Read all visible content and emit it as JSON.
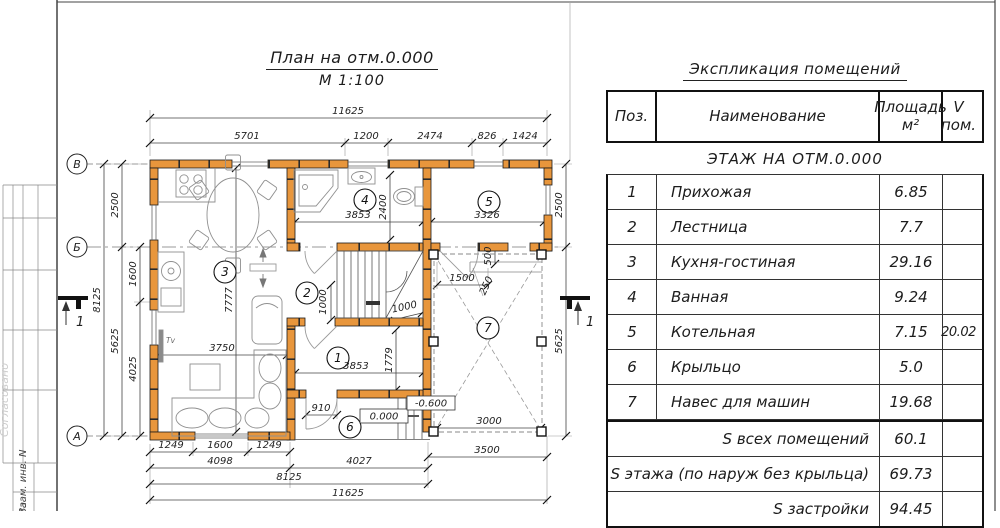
{
  "frame": {
    "approved_label": "Согласовано",
    "inv_label": "Взам. инв. N",
    "date_label": "та"
  },
  "title": {
    "line1": "План на отм.0.000",
    "line2": "М 1:100"
  },
  "axes": {
    "top": "В",
    "mid": "Б",
    "bottom": "А",
    "section": "1"
  },
  "labels": {
    "tv": "Tv"
  },
  "levels": {
    "zero": "0.000",
    "minus": "-0.600"
  },
  "rooms": {
    "n1": "1",
    "n2": "2",
    "n3": "3",
    "n4": "4",
    "n5": "5",
    "n6": "6",
    "n7": "7"
  },
  "dims": {
    "top_total": "11625",
    "t1": "5701",
    "t2": "1200",
    "t3": "2474",
    "t4": "826",
    "t5": "1424",
    "l_total": "8125",
    "l_upper": "2500",
    "l_lower": "5625",
    "l_inner_upper": "1600",
    "l_inner_lower": "4025",
    "r_upper": "2500",
    "r_lower": "5625",
    "b1": "1249",
    "b2": "1600",
    "b3": "1249",
    "b4": "4098",
    "b5": "4027",
    "b6": "8125",
    "b7": "11625",
    "b8": "3500",
    "room4_w": "3853",
    "room4_h": "2400",
    "room5_w": "3326",
    "room1_w": "3853",
    "room1_h": "1779",
    "living_w": "3750",
    "living_h": "7777",
    "stairs_v": "1000",
    "stairs_w": "1000",
    "door_w": "910",
    "cp1": "1500",
    "cp2": "500",
    "cp3": "250",
    "cp4": "3000"
  },
  "table": {
    "title": "Экспликация помещений",
    "headers": {
      "pos": "Поз.",
      "name": "Наименование",
      "area_line1": "Площадь",
      "area_line2": "м²",
      "v_line1": "V",
      "v_line2": "пом."
    },
    "section": "ЭТАЖ НА ОТМ.0.000",
    "rows": [
      {
        "pos": "1",
        "name": "Прихожая",
        "area": "6.85",
        "v": ""
      },
      {
        "pos": "2",
        "name": "Лестница",
        "area": "7.7",
        "v": ""
      },
      {
        "pos": "3",
        "name": "Кухня-гостиная",
        "area": "29.16",
        "v": ""
      },
      {
        "pos": "4",
        "name": "Ванная",
        "area": "9.24",
        "v": ""
      },
      {
        "pos": "5",
        "name": "Котельная",
        "area": "7.15",
        "v": "20.02"
      },
      {
        "pos": "6",
        "name": "Крыльцо",
        "area": "5.0",
        "v": ""
      },
      {
        "pos": "7",
        "name": "Навес для машин",
        "area": "19.68",
        "v": ""
      }
    ],
    "summary": [
      {
        "label": "S всех помещений",
        "value": "60.1"
      },
      {
        "label": "S этажа (по наруж без крыльца)",
        "value": "69.73"
      },
      {
        "label": "S застройки",
        "value": "94.45"
      }
    ]
  }
}
